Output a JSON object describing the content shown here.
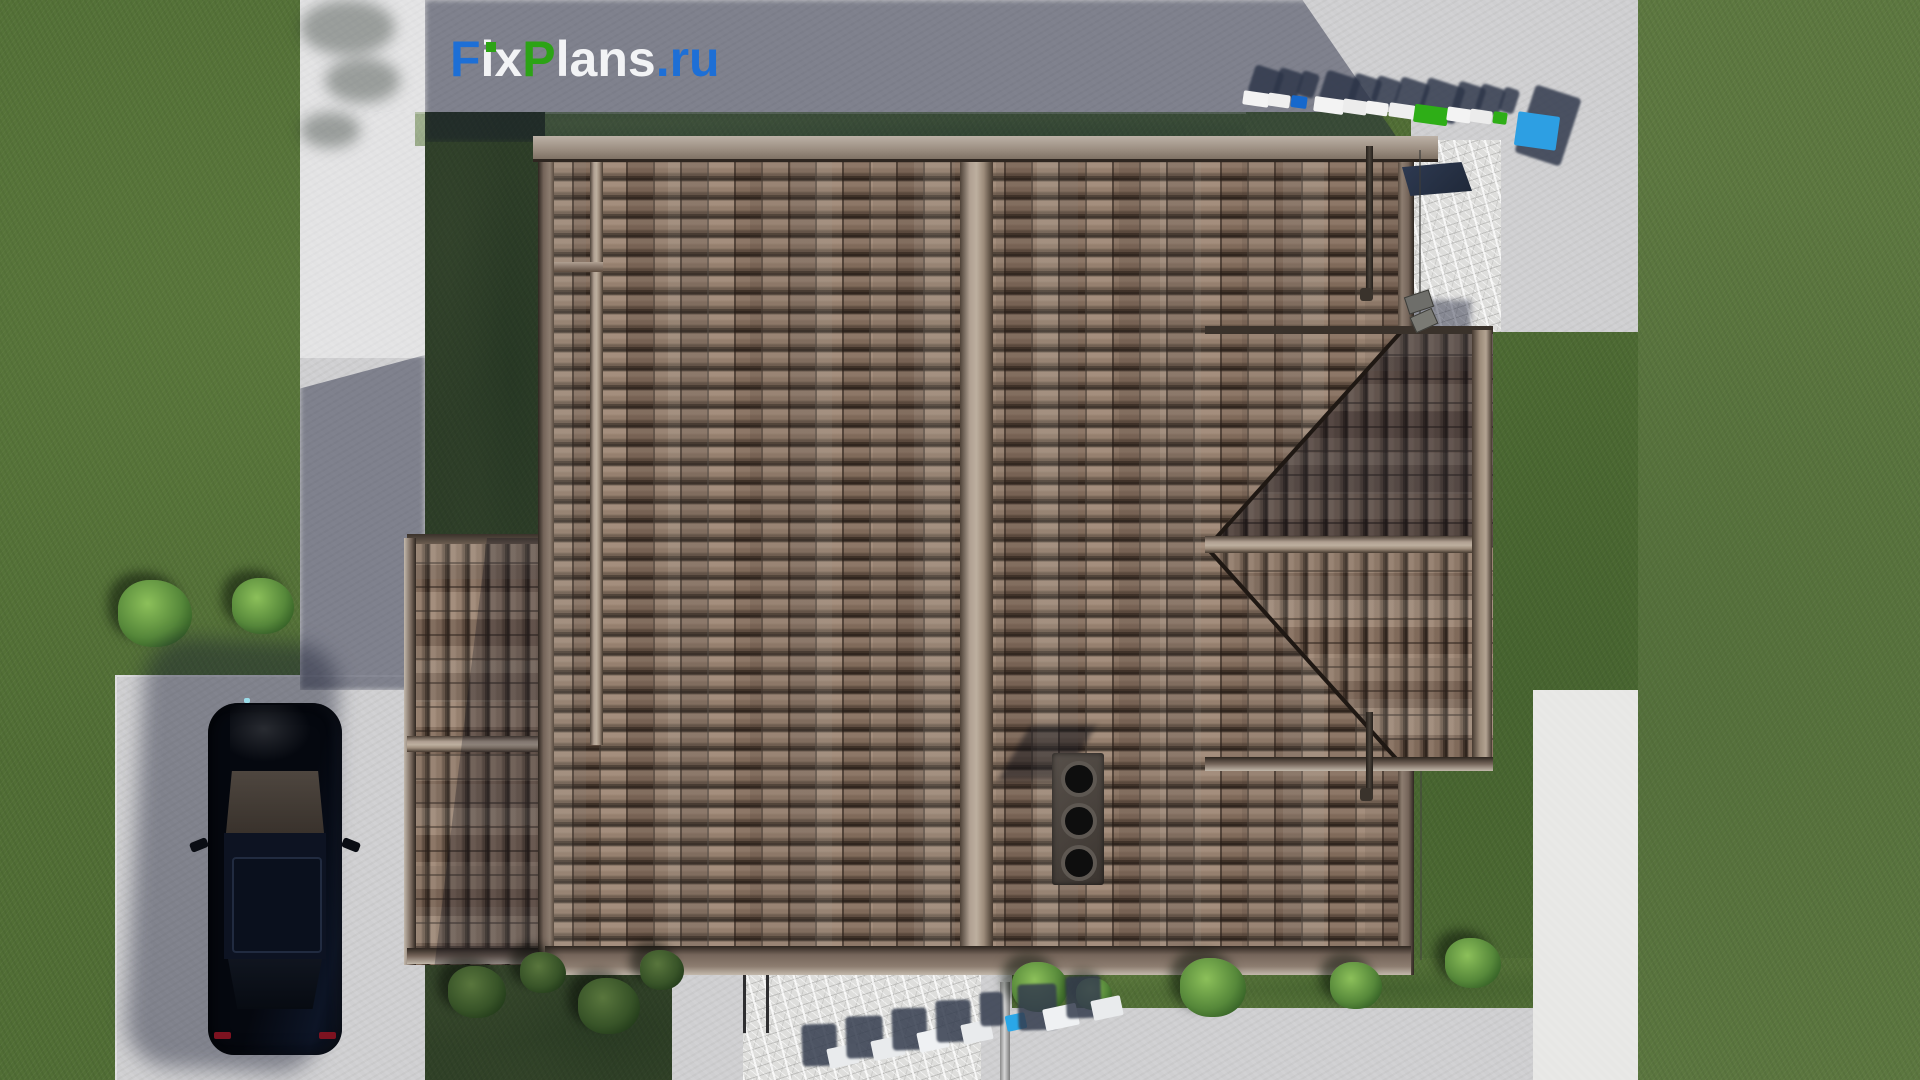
{
  "branding": {
    "logo": {
      "full_text": "FixPlans.ru",
      "segments": [
        {
          "text": "F",
          "color": "#1d6fd6"
        },
        {
          "text": "i",
          "color": "#f2f3f5"
        },
        {
          "text": "x",
          "color": "#f2f3f5"
        },
        {
          "text": "P",
          "color": "#2ca315"
        },
        {
          "text": "lans",
          "color": "#f2f3f5"
        },
        {
          "text": ".",
          "color": "#1d6fd6"
        },
        {
          "text": "ru",
          "color": "#1d6fd6"
        }
      ],
      "i_dot_color": "#2ca315"
    },
    "watermark_top_right_text": "FixPlans.ru",
    "watermark_bottom_text": "plans.ru"
  },
  "scene": {
    "type": "3d-architectural-render",
    "view": "top-down roof plan of a house with tiled roof, driveway with parked car, lawns, paths and patio",
    "chimney_vents": 3,
    "palette": {
      "grass": "#516e35",
      "grass_shaded": "#24341a",
      "concrete": "#cfcfd1",
      "concrete_bright": "#e7e7e5",
      "stone_patio": "#dededc",
      "roof_tile": "#8a7466",
      "roof_ridge": "#b0a092",
      "roof_eave": "#75655a",
      "car_body": "#070b14",
      "car_taillight": "#7d1220",
      "shadow": "rgba(28,34,58,0.45)",
      "logo_blue": "#1d6fd6",
      "logo_green": "#2ca315",
      "watermark_blue": "#2d9fe3",
      "watermark_green": "#2eae17"
    },
    "bushes": [
      {
        "x": 118,
        "y": 580,
        "s": 74,
        "dark": false
      },
      {
        "x": 232,
        "y": 578,
        "s": 62,
        "dark": false
      },
      {
        "x": 448,
        "y": 966,
        "s": 58,
        "dark": true
      },
      {
        "x": 520,
        "y": 952,
        "s": 46,
        "dark": true
      },
      {
        "x": 578,
        "y": 978,
        "s": 62,
        "dark": true
      },
      {
        "x": 640,
        "y": 950,
        "s": 44,
        "dark": true
      },
      {
        "x": 1012,
        "y": 962,
        "s": 56,
        "dark": false
      },
      {
        "x": 1076,
        "y": 978,
        "s": 36,
        "dark": false
      },
      {
        "x": 1180,
        "y": 958,
        "s": 66,
        "dark": false
      },
      {
        "x": 1330,
        "y": 962,
        "s": 52,
        "dark": false
      },
      {
        "x": 1445,
        "y": 938,
        "s": 56,
        "dark": false
      }
    ],
    "watermarks": {
      "top_right": {
        "x": 1243,
        "y": 92,
        "step": 23,
        "dy": 2,
        "angle": 8,
        "shadow": {
          "dx": 8,
          "dy": -24,
          "color": "rgba(44,52,72,0.82)"
        },
        "tiles": [
          {
            "w": 26,
            "h": 14,
            "c": "#f3f3f3"
          },
          {
            "w": 22,
            "h": 13,
            "c": "#efefef"
          },
          {
            "w": 16,
            "h": 12,
            "c": "#1668cc"
          },
          {
            "w": 30,
            "h": 15,
            "c": "#f3f3f3"
          },
          {
            "w": 24,
            "h": 14,
            "c": "#ececec"
          },
          {
            "w": 22,
            "h": 13,
            "c": "#f3f3f3"
          },
          {
            "w": 26,
            "h": 14,
            "c": "#efefef"
          },
          {
            "w": 34,
            "h": 18,
            "c": "#2eae17"
          },
          {
            "w": 24,
            "h": 14,
            "c": "#f3f3f3"
          },
          {
            "w": 22,
            "h": 13,
            "c": "#ececec"
          },
          {
            "w": 14,
            "h": 12,
            "c": "#2eae17"
          },
          {
            "w": 42,
            "h": 34,
            "c": "#2d9fe3"
          }
        ]
      },
      "bottom": {
        "x": 828,
        "y": 1046,
        "step": 38,
        "dy": -8,
        "angle": -12,
        "shadow": {
          "dx": -26,
          "dy": -22,
          "color": "rgba(52,60,78,0.85)"
        },
        "tiles": [
          {
            "w": 30,
            "h": 20,
            "c": "#e9ebed"
          },
          {
            "w": 32,
            "h": 20,
            "c": "#e9ebed"
          },
          {
            "w": 30,
            "h": 20,
            "c": "#eff1f3"
          },
          {
            "w": 30,
            "h": 20,
            "c": "#e9ebed"
          },
          {
            "w": 20,
            "h": 16,
            "c": "#2aa7e8"
          },
          {
            "w": 34,
            "h": 22,
            "c": "#eff1f3"
          },
          {
            "w": 30,
            "h": 20,
            "c": "#e9ebed"
          }
        ]
      }
    }
  }
}
